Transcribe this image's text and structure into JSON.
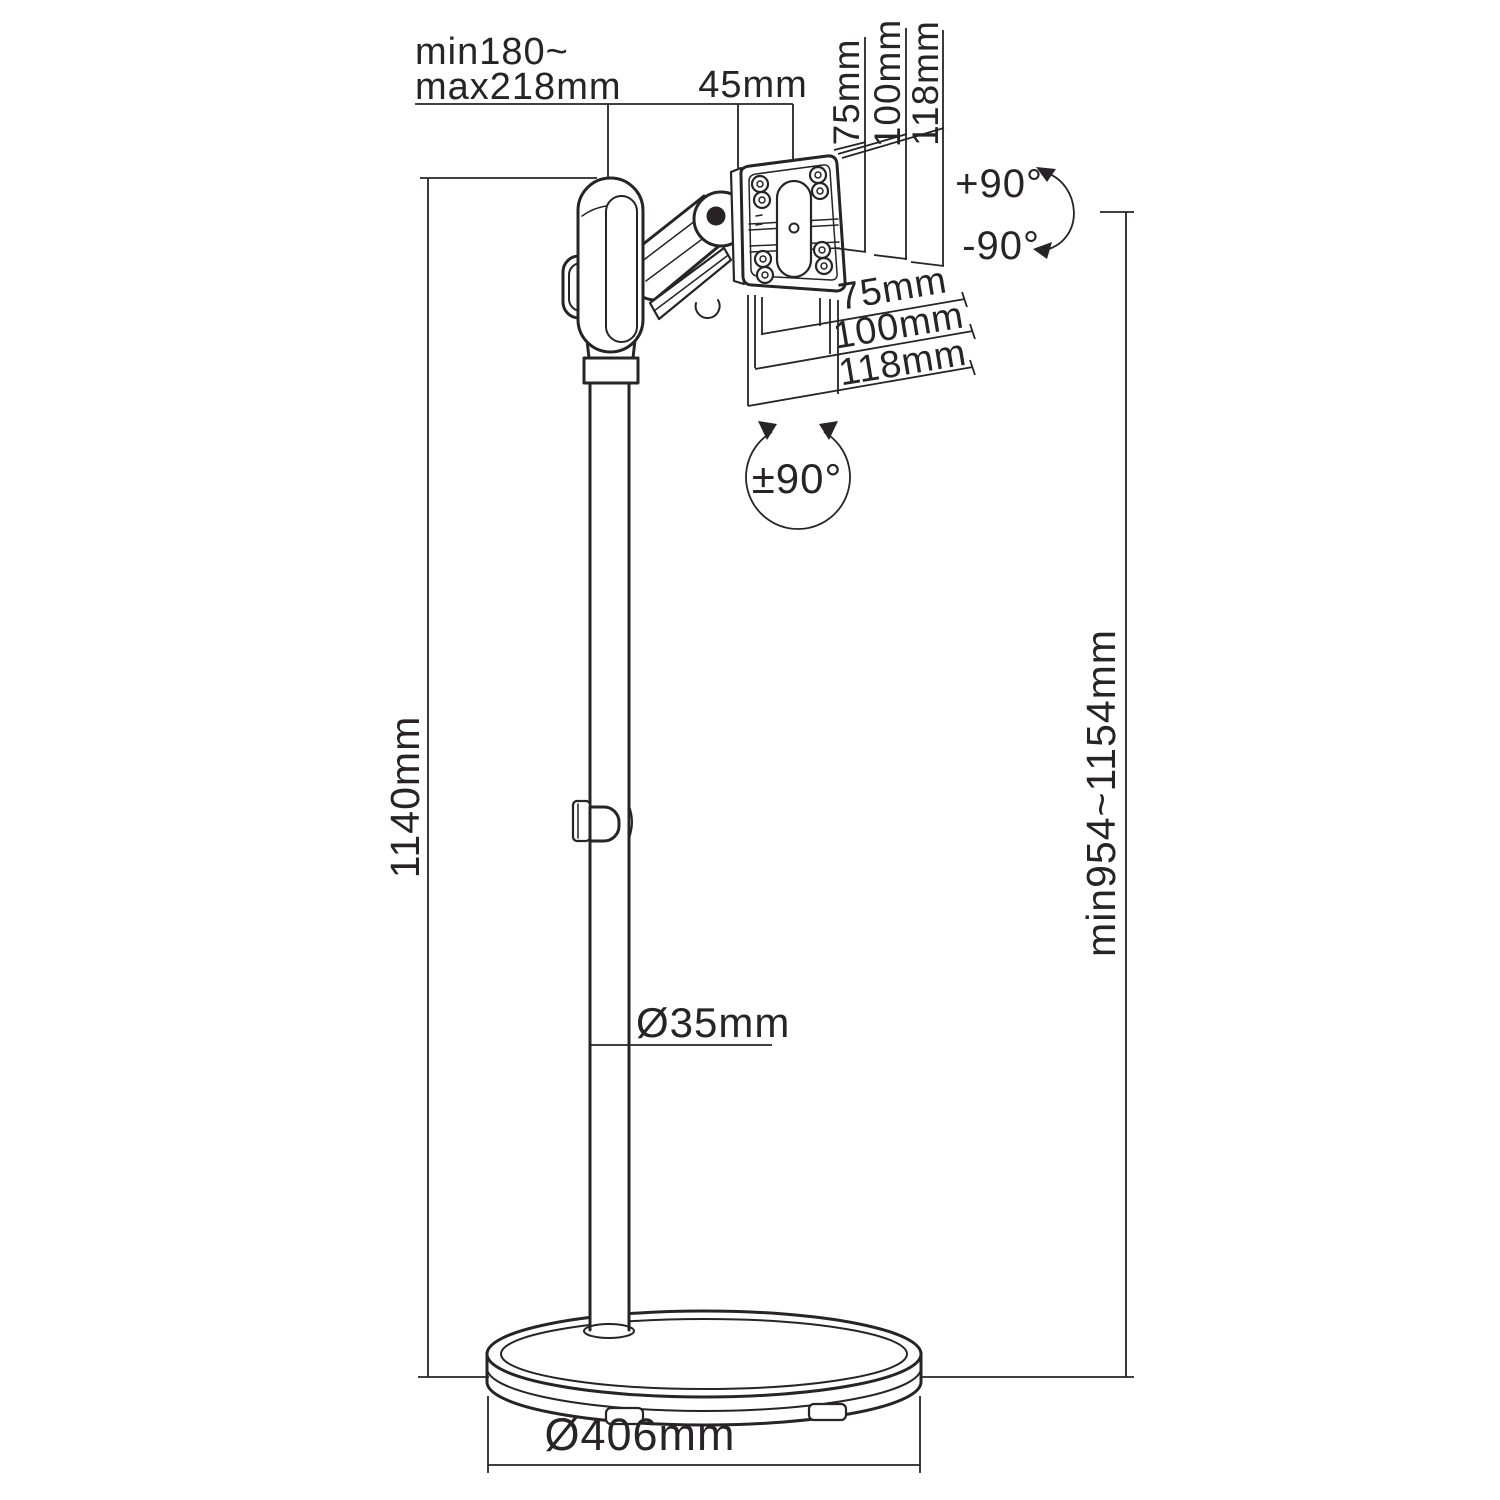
{
  "drawing": {
    "title": "floor-stand-monitor-mount-dimension-drawing",
    "labels": {
      "arm_reach_line1": "min180~",
      "arm_reach_line2": "max218mm",
      "plate_offset": "45mm",
      "vesa_vertical_75": "75mm",
      "vesa_vertical_100": "100mm",
      "vesa_vertical_118": "118mm",
      "tilt_up": "+90°",
      "tilt_down": "-90°",
      "vesa_horizontal_75": "75mm",
      "vesa_horizontal_100": "100mm",
      "vesa_horizontal_118": "118mm",
      "rotation": "±90°",
      "pole_height": "1140mm",
      "height_range": "min954~1154mm",
      "pole_diameter": "Ø35mm",
      "base_diameter": "Ø406mm"
    },
    "colors": {
      "line": "#272327",
      "background": "#ffffff"
    }
  }
}
